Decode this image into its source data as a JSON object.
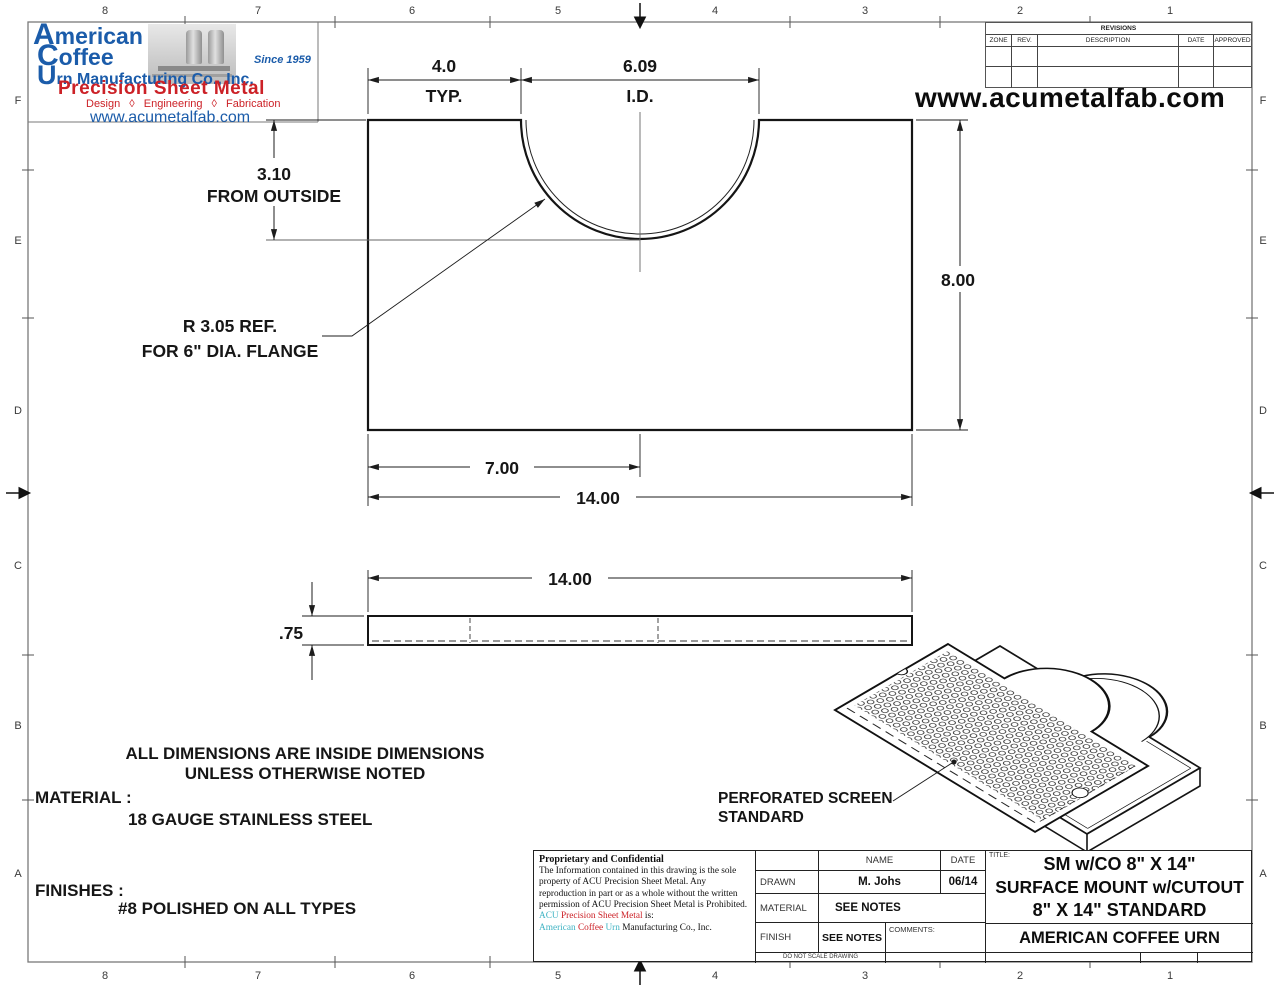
{
  "colors": {
    "logo_blue": "#1b5caa",
    "logo_red": "#cc2127",
    "teal": "#3fb3c3",
    "line": "#151515"
  },
  "logo": {
    "name_line1": "American",
    "name_line2": "Coffee",
    "name_line3": "Urn Manufacturing Co., Inc.",
    "since": "Since 1959",
    "tagline": "Precision Sheet Metal",
    "services": "Design ◊ Engineering ◊ Fabrication",
    "url": "www.acumetalfab.com"
  },
  "header": {
    "url": "www.acumetalfab.com"
  },
  "revisions": {
    "title": "REVISIONS",
    "col_zone": "ZONE",
    "col_rev": "REV.",
    "col_desc": "DESCRIPTION",
    "col_date": "DATE",
    "col_approved": "APPROVED"
  },
  "zones": {
    "cols": [
      "8",
      "7",
      "6",
      "5",
      "4",
      "3",
      "2",
      "1"
    ],
    "rows": [
      "F",
      "E",
      "D",
      "C",
      "B",
      "A"
    ]
  },
  "dims": {
    "width_typ": "4.0",
    "width_typ_label": "TYP.",
    "id": "6.09",
    "id_label": "I.D.",
    "depth": "3.10",
    "depth_label": "FROM OUTSIDE",
    "height": "8.00",
    "center": "7.00",
    "total_width": "14.00",
    "side_width": "14.00",
    "thickness": ".75",
    "radius_note_1": "R 3.05 REF.",
    "radius_note_2": "FOR 6\" DIA. FLANGE"
  },
  "iso": {
    "label_1": "PERFORATED SCREEN",
    "label_2": "STANDARD"
  },
  "notes": {
    "line1": "ALL DIMENSIONS ARE INSIDE DIMENSIONS",
    "line2": "UNLESS OTHERWISE NOTED",
    "material_label": "MATERIAL :",
    "material_value": "18 GAUGE STAINLESS STEEL",
    "finishes_label": "FINISHES :",
    "finishes_value": "#8 POLISHED ON ALL TYPES"
  },
  "title_block": {
    "proprietary_title": "Proprietary and Confidential",
    "proprietary_body": "The Information contained in this drawing is the sole property of ACU Precision Sheet Metal. Any reproduction in part or as a whole without the written permission of ACU Precision Sheet Metal is Prohibited.",
    "acu_line1_a": "ACU ",
    "acu_line1_b": "Precision Sheet Metal ",
    "acu_line1_c": "is:",
    "acu_line2_a": "American ",
    "acu_line2_b": "Coffee ",
    "acu_line2_c": "Urn ",
    "acu_line2_d": "Manufacturing Co., Inc.",
    "name_header": "NAME",
    "date_header": "DATE",
    "drawn_label": "DRAWN",
    "drawn_name": "M. Johs",
    "drawn_date": "06/14",
    "material_label": "MATERIAL",
    "material_value": "SEE NOTES",
    "finish_label": "FINISH",
    "finish_value": "SEE NOTES",
    "comments_label": "COMMENTS:",
    "no_scale": "DO NOT SCALE DRAWING",
    "title_label": "TITLE:",
    "title_line1": "SM w/CO 8\" X 14\"",
    "title_line2": "SURFACE MOUNT w/CUTOUT",
    "title_line3": "8\" X 14\" STANDARD",
    "company": "AMERICAN COFFEE URN"
  }
}
